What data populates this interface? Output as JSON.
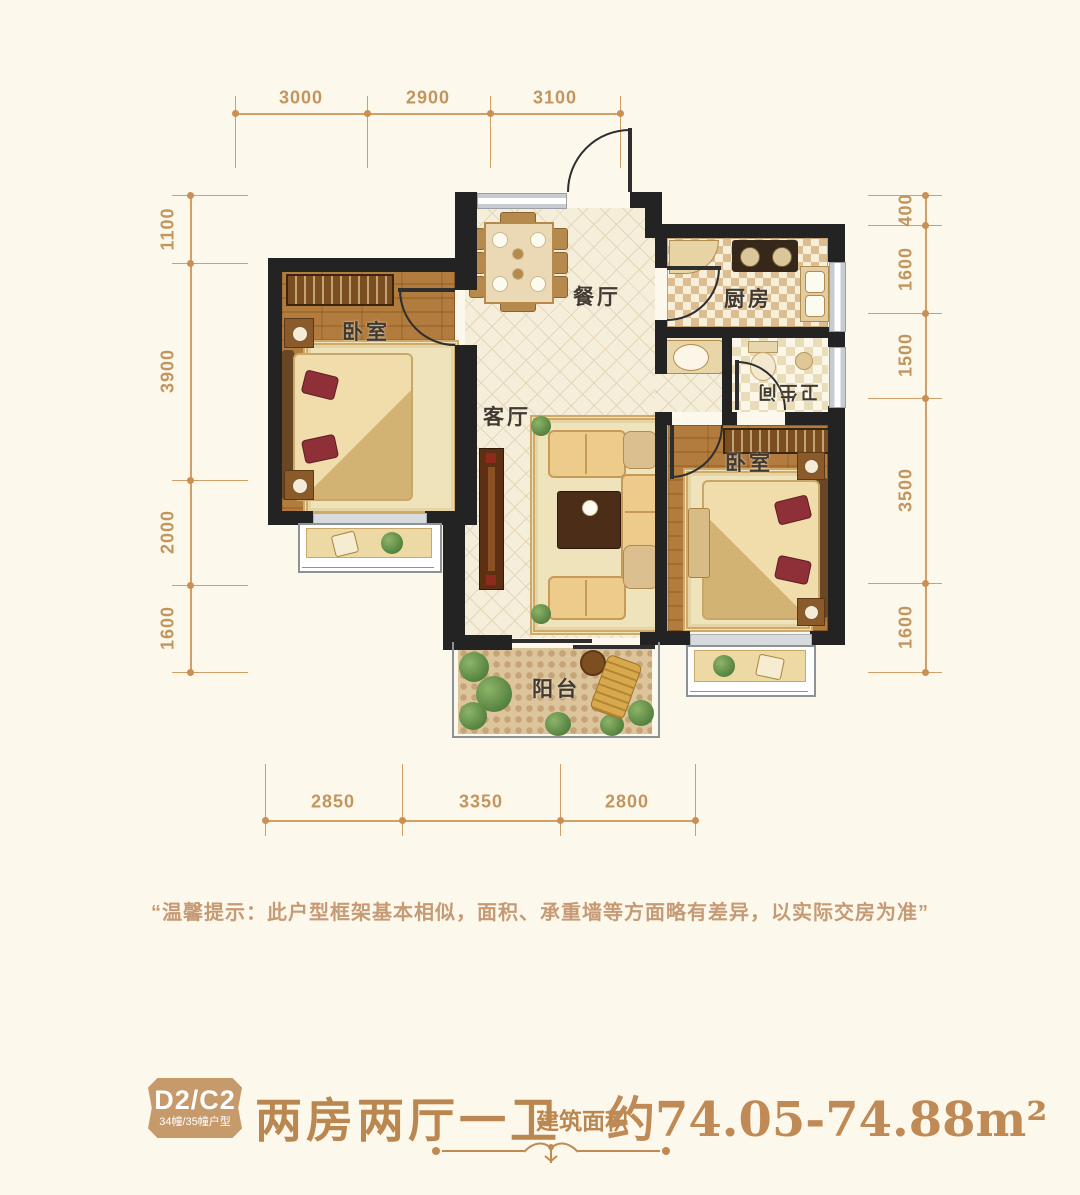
{
  "dims": {
    "top": [
      "3000",
      "2900",
      "3100"
    ],
    "left": [
      "1100",
      "3900",
      "2000",
      "1600"
    ],
    "right": [
      "400",
      "1600",
      "1500",
      "3500",
      "1600"
    ],
    "bottom": [
      "2850",
      "3350",
      "2800"
    ]
  },
  "rooms": {
    "bedroom_left": "卧室",
    "dining": "餐厅",
    "kitchen": "厨房",
    "living": "客厅",
    "bathroom": "卫生间",
    "bedroom_right": "卧室",
    "balcony": "阳台"
  },
  "disclaimer": "“温馨提示：此户型框架基本相似，面积、承重墙等方面略有差异，以实际交房为准”",
  "footer": {
    "unit_code": "D2/C2",
    "unit_buildings": "34幢/35幢户型",
    "title": "两房两厅一卫",
    "area_label": "建筑面积",
    "area_value": "约74.05-74.88m²"
  },
  "colors": {
    "background": "#fdf8ec",
    "dimension": "#d0a067",
    "wall": "#232323",
    "accent_text": "#bb8751",
    "disclaimer_text": "#c69a74",
    "badge_bg": "#c79a6c"
  }
}
